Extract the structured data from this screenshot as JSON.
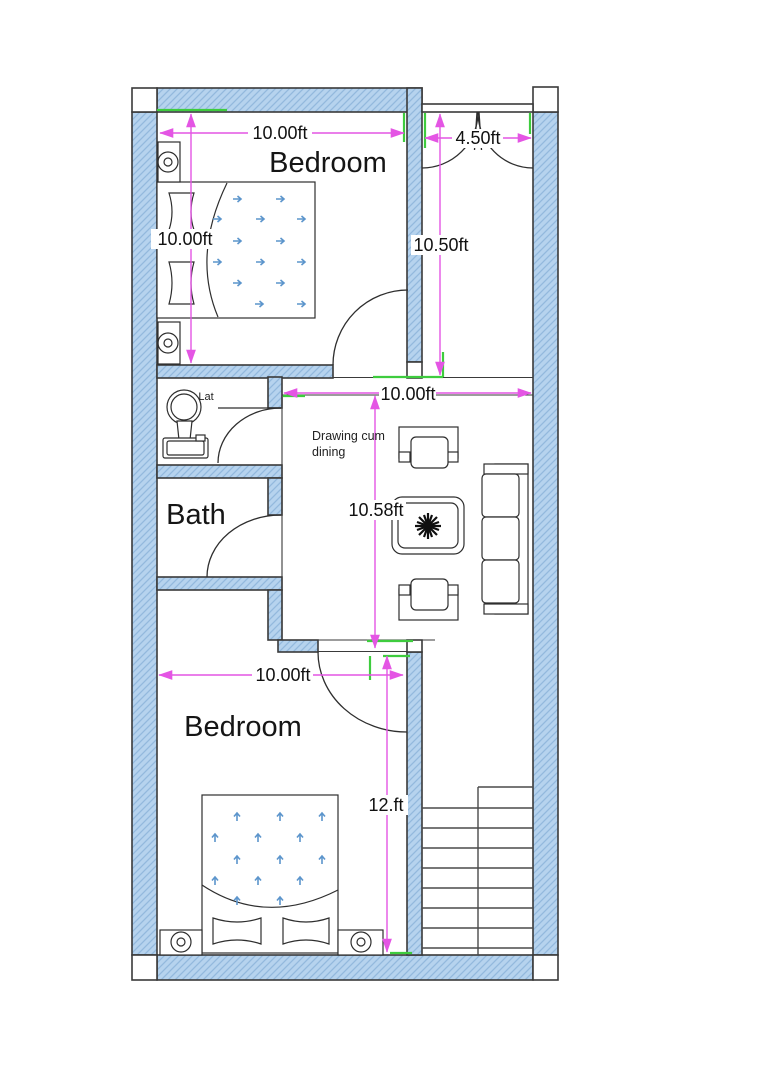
{
  "title": "Two bedroom house floor plan",
  "colors": {
    "paper": "#ffffff",
    "wall_fill": "#b6d3ee",
    "hatch_line": "#93b9dd",
    "outline": "#3a3a3a",
    "dimension": "#e455e4",
    "tick": "#3ecc3e",
    "arrow_blue": "#5c95cc"
  },
  "rooms": {
    "bedroom_top": {
      "label": "Bedroom"
    },
    "lat": {
      "label": "Lat"
    },
    "bath": {
      "label": "Bath"
    },
    "drawing": {
      "label_line1": "Drawing cum",
      "label_line2": "dining"
    },
    "bedroom_bottom": {
      "label": "Bedroom"
    }
  },
  "dimensions": {
    "bedroom_top_width": "10.00ft",
    "bedroom_top_height": "10.00ft",
    "entry_width": "4.50ft",
    "hall_height": "10.50ft",
    "drawing_width": "10.00ft",
    "drawing_height": "10.58ft",
    "bedroom_bottom_width": "10.00ft",
    "bedroom_bottom_height": "12.ft"
  }
}
